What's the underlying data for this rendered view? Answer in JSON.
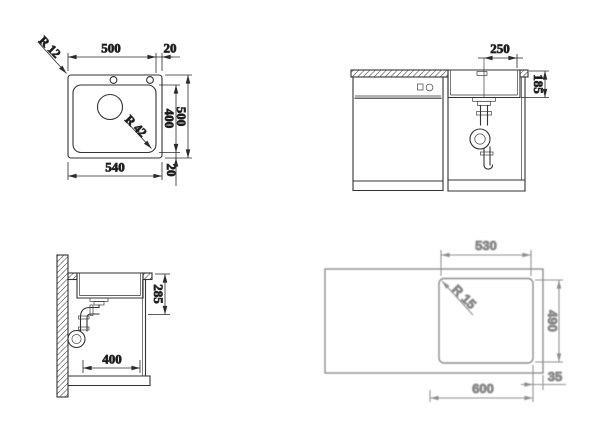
{
  "views": {
    "plan": {
      "dim_bowl_width": "500",
      "dim_edge_top": "20",
      "dim_bowl_depth": "400",
      "dim_overall_depth": "500",
      "dim_edge_bottom": "20",
      "dim_overall_width": "540",
      "radius_corner": "R 12",
      "radius_bowl": "R 42"
    },
    "front": {
      "dim_center_to_edge": "250",
      "dim_bowl_height": "185"
    },
    "side": {
      "dim_clearance": "285",
      "dim_base_depth": "400"
    },
    "cutout": {
      "dim_width": "530",
      "radius": "R 15",
      "dim_depth": "490",
      "dim_cabinet": "600",
      "dim_edge": "35"
    }
  },
  "colors": {
    "line": "#333333",
    "dimension_text": "#141414",
    "cutout_gray": "#8d8d8d"
  }
}
